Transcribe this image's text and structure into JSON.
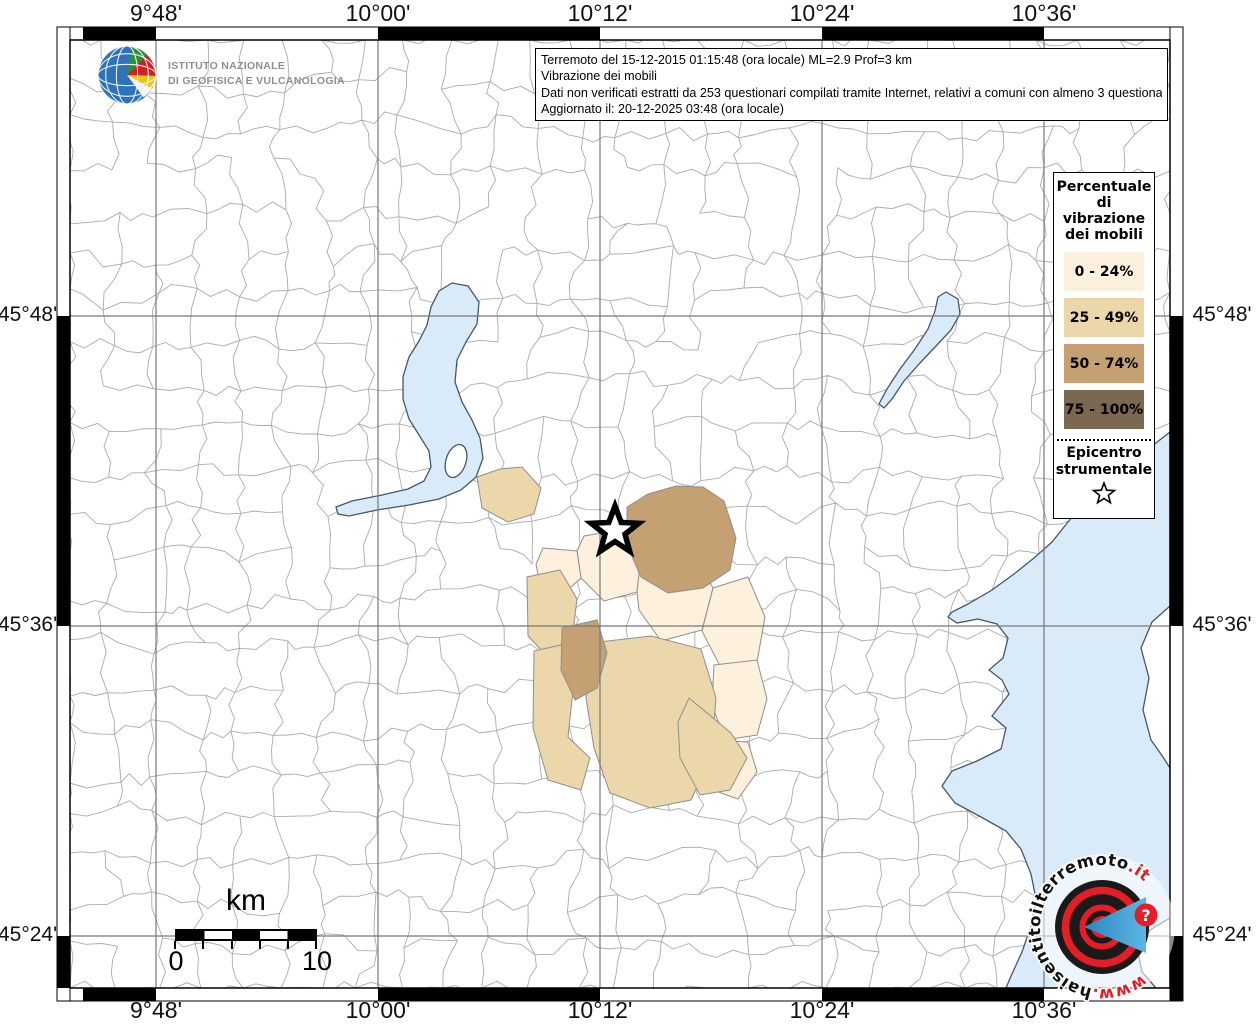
{
  "branding": {
    "ingv_name_line1": "ISTITUTO NAZIONALE",
    "ingv_name_line2": "DI GEOFISICA E VULCANOLOGIA",
    "website": {
      "prefix": "www.",
      "name": "haisentitoilterremoto",
      "tld": ".it",
      "question_mark": "?"
    }
  },
  "info_box": {
    "line1": "Terremoto del 15-12-2015 01:15:48 (ora locale) ML=2.9 Prof=3 km",
    "line2": "Vibrazione dei mobili",
    "line3": "Dati non verificati estratti da 253 questionari compilati tramite Internet, relativi a comuni con almeno 3 questionari.",
    "line4": "Aggiornato il: 20-12-2025 03:48 (ora locale)"
  },
  "legend": {
    "title": "Percentuale di vibrazione dei mobili",
    "items": [
      {
        "label": "0 - 24%",
        "color": "#fdf0dd"
      },
      {
        "label": "25 - 49%",
        "color": "#ecd7aa"
      },
      {
        "label": "50 - 74%",
        "color": "#c4a072"
      },
      {
        "label": "75 - 100%",
        "color": "#7a6850"
      }
    ],
    "epicenter_title": "Epicentro strumentale"
  },
  "axes": {
    "top": [
      "9°48'",
      "10°00'",
      "10°12'",
      "10°24'",
      "10°36'"
    ],
    "bottom": [
      "9°48'",
      "10°00'",
      "10°12'",
      "10°24'",
      "10°36'"
    ],
    "left": [
      "45°48'",
      "45°36'",
      "45°24'"
    ],
    "right": [
      "45°48'",
      "45°36'",
      "45°24'"
    ]
  },
  "scale_bar": {
    "unit": "km",
    "min": "0",
    "max": "10"
  },
  "map": {
    "water_color": "#d9eaf8",
    "boundary_color": "#ababab",
    "grid_color": "#787878"
  }
}
